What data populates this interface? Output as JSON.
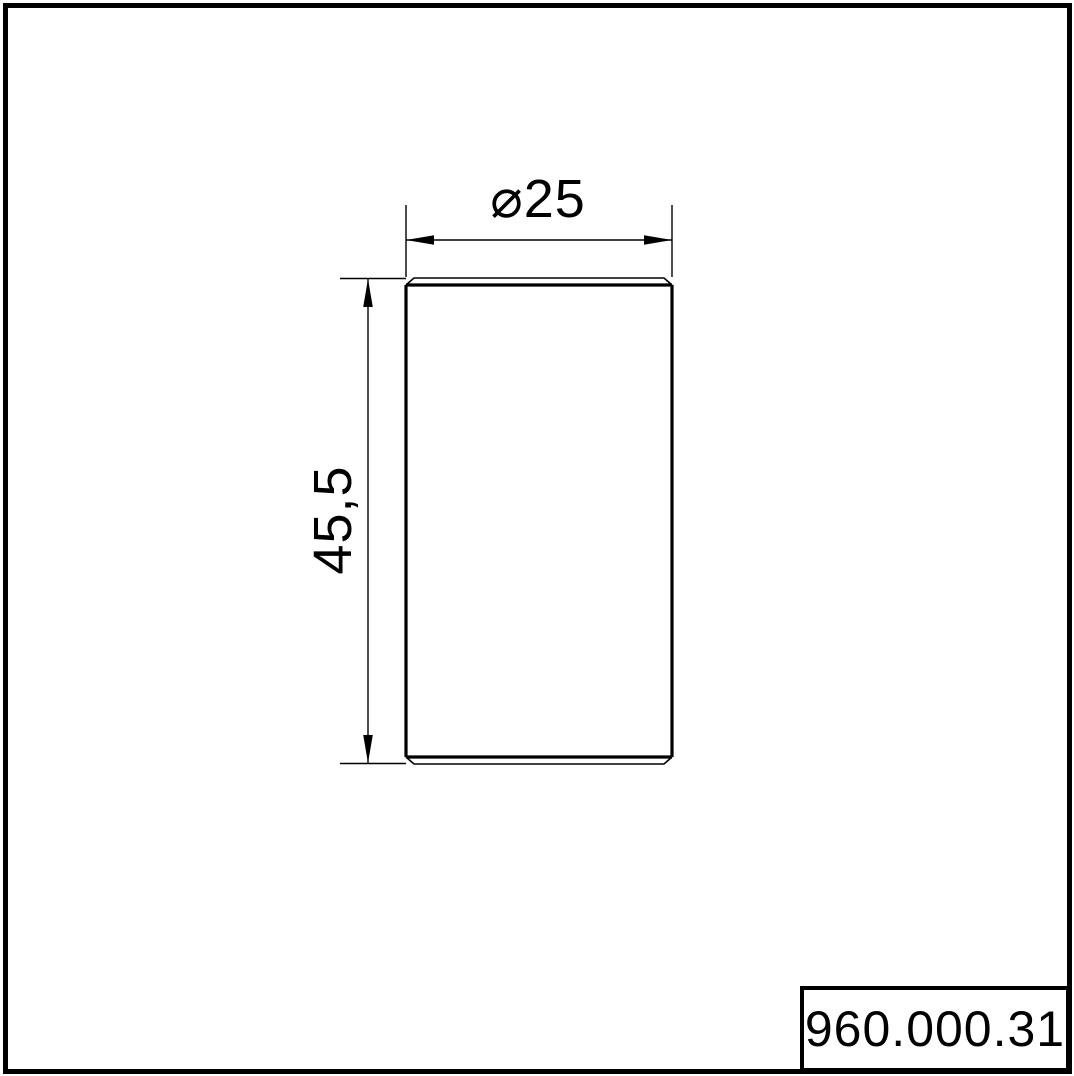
{
  "drawing": {
    "type": "technical-drawing",
    "view": "front view of cylindrical part with chamfered ends",
    "colors": {
      "line": "#000000",
      "background": "#ffffff"
    },
    "dimensions": {
      "diameter": {
        "symbol": "⌀",
        "value": "25",
        "label": "⌀25"
      },
      "height": {
        "value": "45,5",
        "label": "45,5"
      }
    },
    "title_block": {
      "part_number": "960.000.31"
    }
  }
}
